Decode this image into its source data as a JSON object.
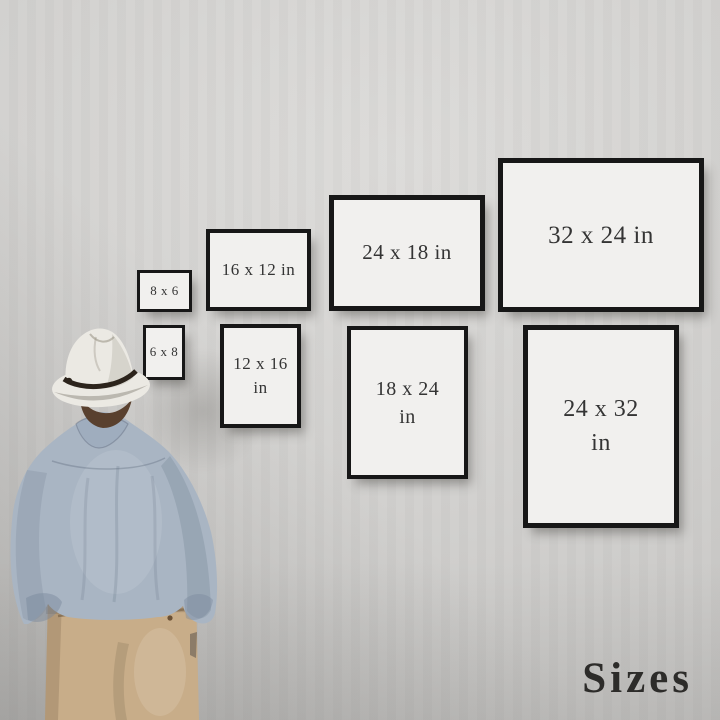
{
  "scene_type": "print size guide mockup photo",
  "frames": [
    {
      "label": "8 x 6",
      "orientation": "landscape"
    },
    {
      "label": "16 x 12 in",
      "orientation": "landscape"
    },
    {
      "label": "24 x 18 in",
      "orientation": "landscape"
    },
    {
      "label": "32 x 24 in",
      "orientation": "landscape"
    },
    {
      "label": "6 x 8",
      "orientation": "portrait"
    },
    {
      "label": "12 x 16 in",
      "orientation": "portrait"
    },
    {
      "label": "18 x 24 in",
      "orientation": "portrait"
    },
    {
      "label": "24 x 32 in",
      "orientation": "portrait"
    }
  ],
  "caption": {
    "text": "Sizes",
    "color": "#2d2c2a"
  },
  "frame_style": {
    "border_color": "#171717",
    "paper_color": "#f1f0ee",
    "text_color": "#343434"
  },
  "wall": {
    "base_color": "#d1d0ce",
    "highlight_color": "#dcdbd9",
    "shade_color": "#c2c1bf"
  },
  "figure": {
    "hat_color": "#ebe9e3",
    "hat_band_color": "#2c241c",
    "hair_color": "#59402e",
    "shirt_color": "#a9b5c3",
    "collar_color": "#9fadbe",
    "pants_color": "#c8ad89"
  }
}
